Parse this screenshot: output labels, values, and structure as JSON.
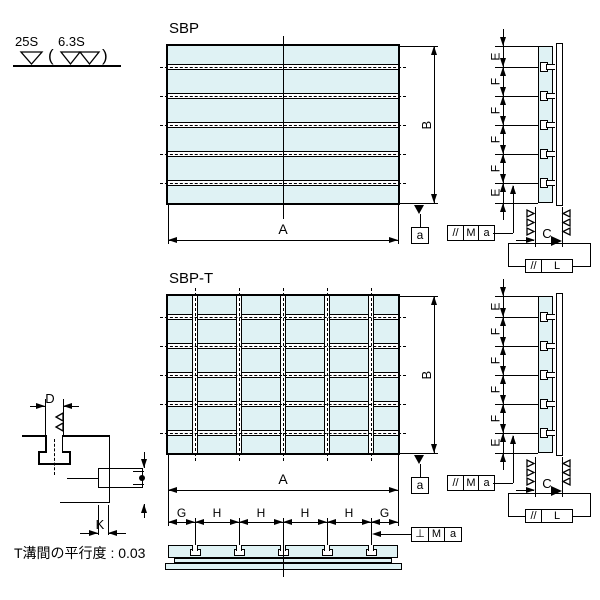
{
  "colors": {
    "background": "#ffffff",
    "plate_fill": "#dff2f4",
    "line_color": "#000000"
  },
  "surface_finish_note": {
    "outer_value": "25S",
    "inner_value": "6.3S",
    "open_paren": "(",
    "close_paren": ")"
  },
  "views": {
    "sbp": {
      "title": "SBP",
      "width_label": "A",
      "height_label": "B",
      "datum_label": "a"
    },
    "sbp_t": {
      "title": "SBP-T",
      "width_label": "A",
      "height_label": "B",
      "datum_label": "a"
    }
  },
  "side_view": {
    "spacing_labels": [
      "E",
      "F",
      "F",
      "F",
      "F",
      "E"
    ],
    "thickness_label": "C",
    "parallelism_frame": [
      "//",
      "M",
      "a"
    ],
    "side_parallelism_frame": [
      "//",
      "L"
    ]
  },
  "section_view": {
    "segment_labels": [
      "G",
      "H",
      "H",
      "H",
      "H",
      "G"
    ],
    "perpendicularity_frame": [
      "⊥",
      "M",
      "a"
    ]
  },
  "detail_view": {
    "slot_width_label": "D",
    "slot_offset_label": "K"
  },
  "note": "T溝間の平行度 : 0.03"
}
